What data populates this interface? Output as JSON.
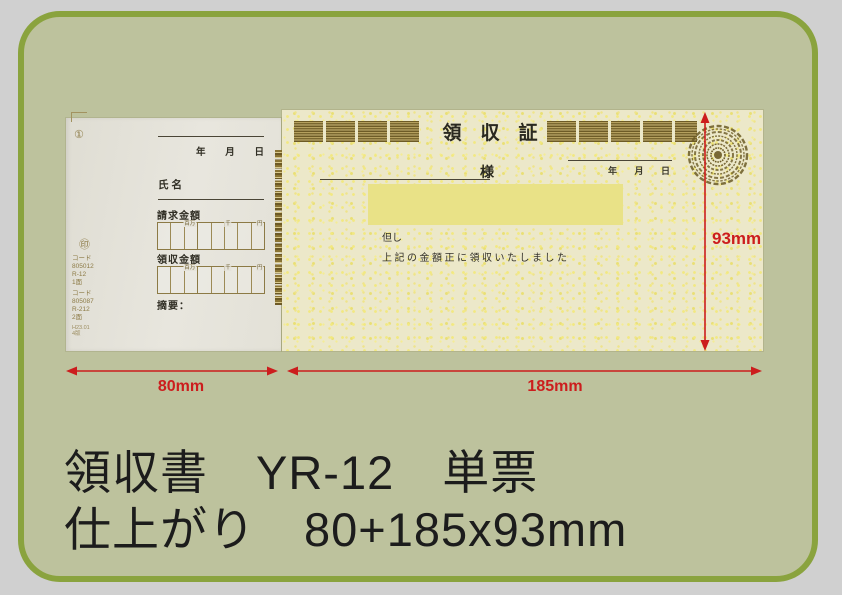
{
  "colors": {
    "page_bg": "#d0d0d0",
    "panel_fill": "#bdc29d",
    "panel_border": "#8aa33e",
    "dimension_red": "#cc1d1d",
    "stub_paper": "#e5e3da",
    "main_paper": "#ece8c9",
    "amount_highlight": "#e9e287",
    "ornament_brown": "#74622a",
    "caption_text": "#1c1c1c"
  },
  "caption": {
    "line1": "領収書　YR-12　単票",
    "line2": "仕上がり　80+185x93mm"
  },
  "dimensions": {
    "stub_width": "80mm",
    "main_width": "185mm",
    "height": "93mm"
  },
  "stub": {
    "circle_mark": "①",
    "date_year": "年",
    "date_month": "月",
    "date_day": "日",
    "name_label": "氏名",
    "billing_label": "請求金額",
    "received_label": "領収金額",
    "remarks_label": "摘要：",
    "unit_million": "百万",
    "unit_thousand": "千",
    "unit_yen": "円",
    "seal_mark": "㊞",
    "code_block1": [
      "コード",
      "805012",
      "R-12",
      "1面"
    ],
    "code_block2": [
      "コード",
      "805087",
      "R-212",
      "2面"
    ],
    "footnote": [
      "H23.01",
      "4版"
    ]
  },
  "main": {
    "title": "領　収　証",
    "addressee_suffix": "様",
    "date_year": "年",
    "date_month": "月",
    "date_day": "日",
    "proviso": "但し",
    "statement": "上記の金額正に領収いたしました"
  }
}
